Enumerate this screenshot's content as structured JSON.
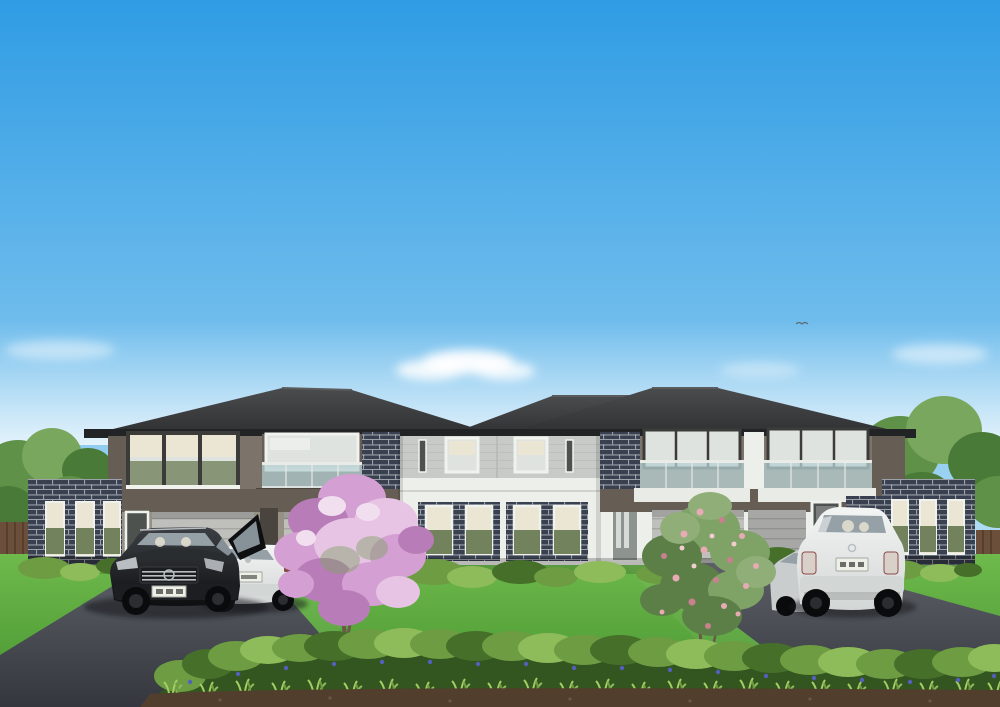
{
  "scene": {
    "type": "architectural-render",
    "description": "Front elevation render of a two-storey multi-dwelling townhouse development with dark hipped roof, taupe and white walls, dark brick piers, glass balconies, double garages, green lawn, two driveways with parked cars (black SUV, white wagon, white SUV), flowering pink trees and a foreground hedge under a clear blue sky",
    "objects": [
      "sky",
      "clouds",
      "bird",
      "background-trees",
      "timber-fence",
      "hipped-roof",
      "left-brick-wing",
      "left-townhouse",
      "center-section",
      "right-townhouse",
      "right-brick-wing",
      "balcony-glass-balustrade",
      "garage-doors",
      "entry-doors",
      "windows-with-blinds",
      "lawn",
      "left-driveway",
      "right-driveway",
      "base-shrubs",
      "pink-flowering-tree",
      "rose-flowering-shrub",
      "black-suv",
      "white-wagon",
      "white-suv",
      "silver-car",
      "foreground-hedge",
      "blue-flower-border",
      "mulch-strip"
    ]
  },
  "palette": {
    "sky_top": "#2f9ce4",
    "sky_mid": "#7cc3ee",
    "sky_horizon": "#eef8fd",
    "haze": "#ffffff",
    "roof_hi": "#4b4c4e",
    "roof_lo": "#2e2f31",
    "fascia": "#222324",
    "ridge": "#5a5b5d",
    "wall_taupe": "#7c746a",
    "wall_taupe_dark": "#665e55",
    "underside_dark": "#4a443e",
    "wall_gray": "#c7cac6",
    "siding_line": "#b4b7b3",
    "wall_white": "#edefeb",
    "wall_greige": "#979185",
    "brick_bg": "#394050",
    "brick_mortar": "#c6c9cd",
    "frame_white": "#f0f2ee",
    "frame_dark": "#3b3b39",
    "blind_cream": "#ebe5d4",
    "glass_light": "#dfe3e0",
    "glass_green": "#72825c",
    "glass_dark": "#4e524f",
    "glass_balcony": "#b7d0d3",
    "rail_white": "#e9ebe7",
    "garage_light": "#bfc0bc",
    "garage_line": "#a6a7a3",
    "door_dark": "#49453e",
    "door_gray": "#8d938f",
    "lawn_light": "#6fba4c",
    "lawn_dark": "#459330",
    "shadow_green": "#2f5a22",
    "drive_hi": "#5c6066",
    "drive_lo": "#34383e",
    "hedge_light": "#8fbc5a",
    "hedge_mid": "#6d9c42",
    "hedge_dark": "#466f2a",
    "hedge_deep": "#33551f",
    "blade_green": "#a3cd63",
    "flower_blue": "#5261bb",
    "dirt": "#523e2d",
    "dirt_light": "#6f563e",
    "pink_light": "#e7c4e4",
    "pink_mid": "#d49fd2",
    "pink_deep": "#b87cb8",
    "pink_hi": "#f1dff0",
    "rose_pink": "#e8aab4",
    "rose_deep": "#c9808f",
    "leaf_light": "#8fae78",
    "leaf_mid": "#7fa266",
    "leaf_dark": "#5c7f47",
    "trunk": "#6b5847",
    "bg_tree_hi": "#79a75e",
    "bg_tree_mid": "#5f9148",
    "bg_tree_dark": "#4a7a38",
    "fence": "#6b4f3a",
    "fence_dark": "#55402e",
    "car_black_hi": "#3c4045",
    "car_black": "#0e0f11",
    "car_white_hi": "#f3f5f4",
    "car_white_lo": "#d2d6d5",
    "car_silver": "#c9cdce",
    "car_glass": "#95a0a7",
    "chrome": "#b9bec2",
    "tire": "#0a0b0c",
    "rim": "#2b2d30",
    "plate": "#eef0e8",
    "taillight": "#8a4a48",
    "taillight_suv": "#d9d0ca",
    "bird": "#5b6b77",
    "shadow": "#15181a"
  }
}
